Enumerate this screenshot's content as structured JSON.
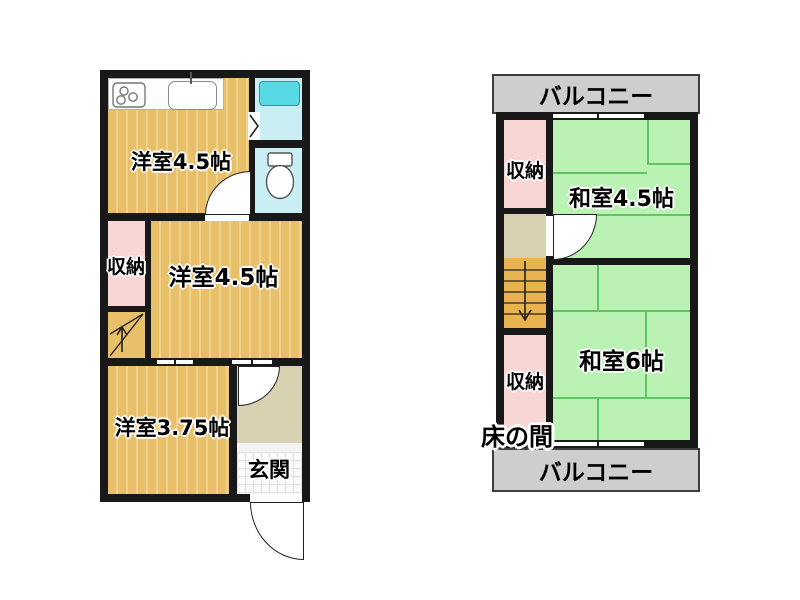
{
  "floorplan": {
    "floor1": {
      "room_yoshitsu_top": "洋室4.5帖",
      "closet": "収納",
      "room_yoshitsu_mid": "洋室4.5帖",
      "room_yoshitsu_btm": "洋室3.75帖",
      "entrance": "玄関"
    },
    "floor2": {
      "balcony_top": "バルコニー",
      "closet_top": "収納",
      "washitsu_45": "和室4.5帖",
      "washitsu_6": "和室6帖",
      "closet_btm": "収納",
      "tokonoma": "床の間",
      "balcony_btm": "バルコニー"
    },
    "icons": [
      "stove-icon",
      "sink-icon",
      "bathtub-icon",
      "toilet-icon",
      "folding-door-icon",
      "door-swing-arc",
      "stairs-up-arrow",
      "stairs-down-arrow",
      "window-gap"
    ],
    "colors": {
      "wall": "#181818",
      "wood_floor": "#e9c06a",
      "wood_stripe": "#f1d28c",
      "tatami_green": "#b9f2b3",
      "tatami_line": "#64c364",
      "closet_pink": "#f8d6d4",
      "bath_cyan": "#c9eef3",
      "bathtub_cyan": "#59d9e3",
      "hall_beige": "#d8d2b2",
      "stairs_orange": "#e9b350",
      "balcony_gray": "#cecece"
    }
  }
}
